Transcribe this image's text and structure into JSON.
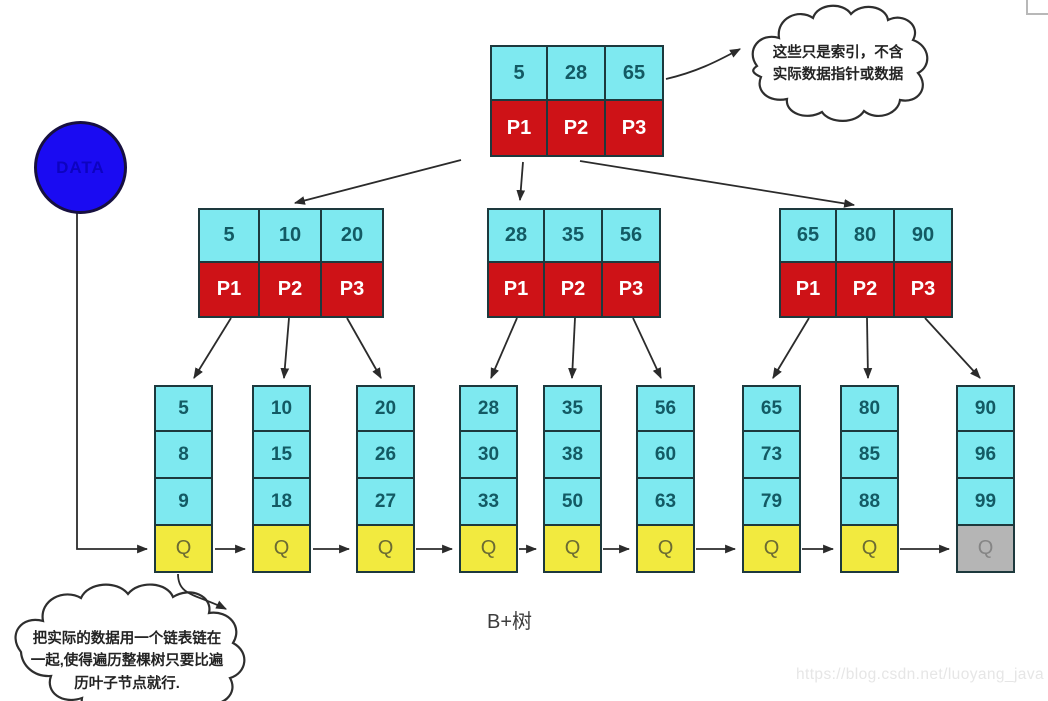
{
  "diagram": {
    "caption": "B+树",
    "watermark": "https://blog.csdn.net/luoyang_java",
    "data_circle_label": "DATA",
    "top_callout": "这些只是索引，不含实际数据指针或数据",
    "bottom_callout": "把实际的数据用一个链表链在一起,使得遍历整棵树只要比遍历叶子节点就行."
  },
  "tree": {
    "root": {
      "keys": [
        "5",
        "28",
        "65"
      ],
      "pointers": [
        "P1",
        "P2",
        "P3"
      ]
    },
    "internal_nodes": [
      {
        "keys": [
          "5",
          "10",
          "20"
        ],
        "pointers": [
          "P1",
          "P2",
          "P3"
        ]
      },
      {
        "keys": [
          "28",
          "35",
          "56"
        ],
        "pointers": [
          "P1",
          "P2",
          "P3"
        ]
      },
      {
        "keys": [
          "65",
          "80",
          "90"
        ],
        "pointers": [
          "P1",
          "P2",
          "P3"
        ]
      }
    ],
    "leaf_nodes": [
      {
        "values": [
          "5",
          "8",
          "9"
        ],
        "tail": "Q",
        "tail_style": "yellow"
      },
      {
        "values": [
          "10",
          "15",
          "18"
        ],
        "tail": "Q",
        "tail_style": "yellow"
      },
      {
        "values": [
          "20",
          "26",
          "27"
        ],
        "tail": "Q",
        "tail_style": "yellow"
      },
      {
        "values": [
          "28",
          "30",
          "33"
        ],
        "tail": "Q",
        "tail_style": "yellow"
      },
      {
        "values": [
          "35",
          "38",
          "50"
        ],
        "tail": "Q",
        "tail_style": "yellow"
      },
      {
        "values": [
          "56",
          "60",
          "63"
        ],
        "tail": "Q",
        "tail_style": "yellow"
      },
      {
        "values": [
          "65",
          "73",
          "79"
        ],
        "tail": "Q",
        "tail_style": "yellow"
      },
      {
        "values": [
          "80",
          "85",
          "88"
        ],
        "tail": "Q",
        "tail_style": "yellow"
      },
      {
        "values": [
          "90",
          "96",
          "99"
        ],
        "tail": "Q",
        "tail_style": "gray"
      }
    ]
  },
  "colors": {
    "key_cell": "#7ee9f0",
    "pointer_cell": "#ce1217",
    "tail_cell": "#f2ea3f",
    "tail_cell_last": "#b5b5b5",
    "data_circle": "#1a0bf2",
    "border": "#1d393d",
    "arrow": "#2b2b2b"
  }
}
